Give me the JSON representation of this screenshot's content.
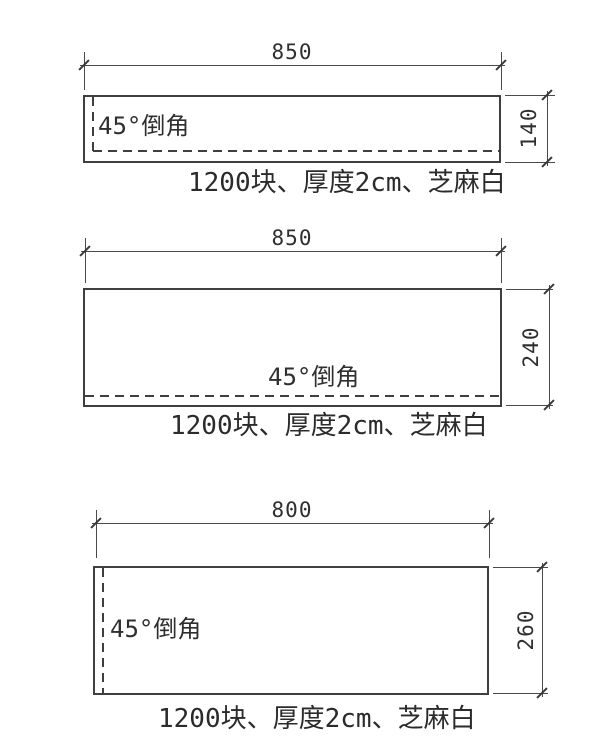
{
  "panels": [
    {
      "width_label": "850",
      "height_label": "140",
      "chamfer_label": "45°倒角",
      "caption": "1200块、厚度2cm、芝麻白"
    },
    {
      "width_label": "850",
      "height_label": "240",
      "chamfer_label": "45°倒角",
      "caption": "1200块、厚度2cm、芝麻白"
    },
    {
      "width_label": "800",
      "height_label": "260",
      "chamfer_label": "45°倒角",
      "caption": "1200块、厚度2cm、芝麻白"
    }
  ],
  "colors": {
    "outline": "#3f3f3f",
    "dimension_line": "#4a4a4a",
    "text": "#2f2f2f",
    "background": "#ffffff"
  }
}
